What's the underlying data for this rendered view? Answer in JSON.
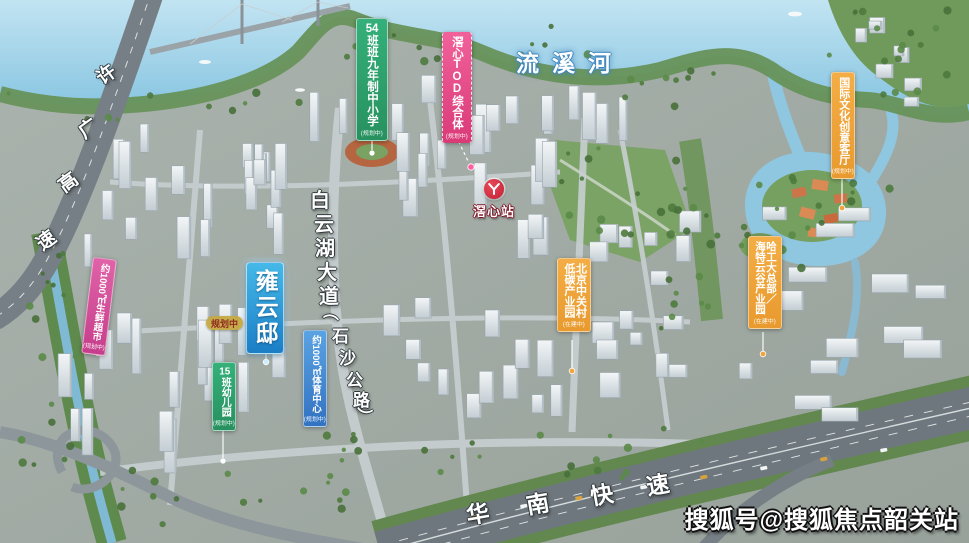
{
  "river": {
    "name": "流溪河"
  },
  "station": {
    "name": "滘心站"
  },
  "roads": {
    "xuguang": {
      "chars": [
        "许",
        "广",
        "高",
        "速"
      ]
    },
    "huanan": {
      "chars": [
        "华",
        "南",
        "快",
        "速"
      ]
    },
    "baiyunhu": {
      "chars": [
        "白",
        "云",
        "湖",
        "大",
        "道"
      ]
    },
    "shisha": {
      "chars": [
        "（",
        "石",
        "沙",
        "公",
        "路",
        "）"
      ]
    }
  },
  "labels": {
    "school": {
      "num": "54",
      "text": "班班九年制中小学",
      "status": "(规划中)"
    },
    "tod": {
      "text": "滘心TOD综合体",
      "status": "(规划中)"
    },
    "creative": {
      "text": "国际文化创意客厅",
      "status": "(规划中)"
    },
    "hit": {
      "col1": "哈工大总部／",
      "col2": "海特云谷产业园",
      "status": "(在建中)"
    },
    "zgc": {
      "col1": "北京中关村",
      "col2": "低碳产业园",
      "status": "(在建中)"
    },
    "project": {
      "name": "雍云邸"
    },
    "planning_pill": {
      "text": "规划中"
    },
    "supermarket": {
      "text": "约1000㎡生鲜超市",
      "status": "(规划中)"
    },
    "kindergarten": {
      "num": "15",
      "text": "班幼儿园",
      "status": "(规划中)"
    },
    "sports": {
      "text": "约1000㎡体育中心",
      "status": "(规划中)"
    }
  },
  "watermark": {
    "text": "搜狐号@搜狐焦点韶关站"
  },
  "colors": {
    "green": "#2ea36d",
    "pink": "#e84f86",
    "orange": "#f0a53c",
    "project_blue": "#2b9fd9",
    "magenta": "#d8509b",
    "water": "#8cc6e2",
    "metro_red": "#c21f33"
  }
}
